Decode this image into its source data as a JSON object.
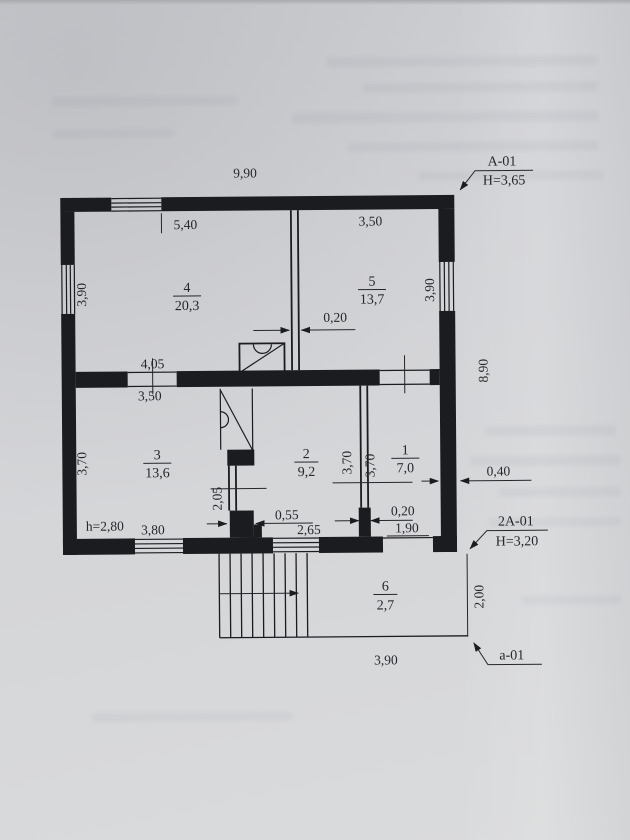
{
  "plan": {
    "rooms": [
      {
        "number": "4",
        "area": "20,3"
      },
      {
        "number": "5",
        "area": "13,7"
      },
      {
        "number": "3",
        "area": "13,6"
      },
      {
        "number": "2",
        "area": "9,2"
      },
      {
        "number": "1",
        "area": "7,0"
      },
      {
        "number": "6",
        "area": "2,7"
      }
    ],
    "markers": {
      "top": {
        "name": "A-01",
        "height": "H=3,65"
      },
      "middle": {
        "name": "2A-01",
        "height": "H=3,20"
      },
      "bottom": {
        "name": "a-01"
      }
    },
    "dimensions": {
      "overall_width": "9,90",
      "overall_depth": "8,90",
      "top_window": "5,40",
      "room5_top": "3,50",
      "left_window": "3,90",
      "right_window": "3,90",
      "partition_4_5": "0,20",
      "mid_opening": "4,05",
      "room3_width": "3,50",
      "room3_depth": "3,70",
      "stair_wall": "2,05",
      "room2_depth": "3,70",
      "room1_depth": "3,70",
      "right_wall": "0,40",
      "ceiling": "h=2,80",
      "window_left_bottom": "3,80",
      "pier_width": "0,55",
      "window_mid_bottom": "2,65",
      "partition_2_1": "0,20",
      "door_bottom": "1,90",
      "porch_depth": "2,00",
      "porch_width": "3,90"
    },
    "colors": {
      "paper": "#d3d4d7",
      "ink": "#1b1c20"
    }
  }
}
